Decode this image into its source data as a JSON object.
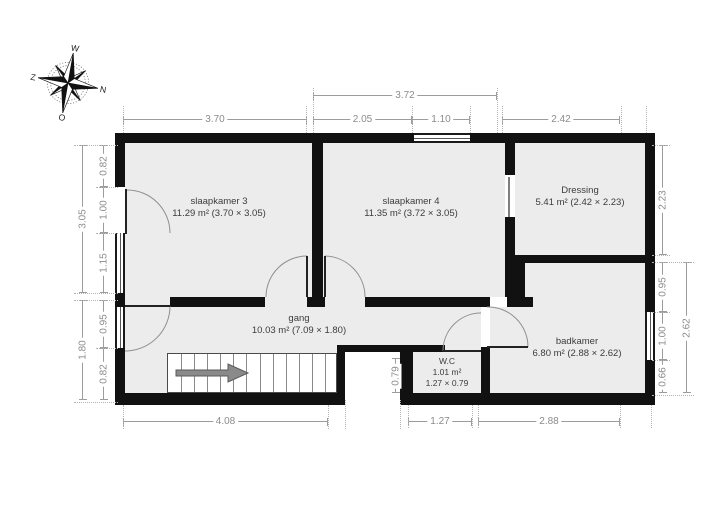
{
  "compass": {
    "top": "W",
    "right": "N",
    "bottom": "O",
    "left": "Z"
  },
  "rooms": [
    {
      "name": "slaapkamer 3",
      "info": "11.29 m² (3.70 × 3.05)"
    },
    {
      "name": "slaapkamer 4",
      "info": "11.35 m² (3.72 × 3.05)"
    },
    {
      "name": "Dressing",
      "info": "5.41 m² (2.42 × 2.23)"
    },
    {
      "name": "gang",
      "info": "10.03 m² (7.09 × 1.80)"
    },
    {
      "name": "W.C",
      "info": "1.01 m²",
      "info2": "1.27 × 0.79"
    },
    {
      "name": "badkamer",
      "info": "6.80 m² (2.88 × 2.62)"
    }
  ],
  "dimensions": [
    {
      "label": "3.72",
      "side": "top",
      "o": "h",
      "x": 313,
      "y": 95,
      "len": 184
    },
    {
      "label": "3.70",
      "side": "top",
      "o": "h",
      "x": 123,
      "y": 119,
      "len": 184
    },
    {
      "label": "2.05",
      "side": "top",
      "o": "h",
      "x": 313,
      "y": 119,
      "len": 99
    },
    {
      "label": "1.10",
      "side": "top",
      "o": "h",
      "x": 412,
      "y": 119,
      "len": 58
    },
    {
      "label": "2.42",
      "side": "top",
      "o": "h",
      "x": 502,
      "y": 119,
      "len": 118
    },
    {
      "label": "3.05",
      "side": "left",
      "o": "v",
      "x": 82,
      "y": 145,
      "len": 148
    },
    {
      "label": "1.80",
      "side": "left",
      "o": "v",
      "x": 82,
      "y": 300,
      "len": 100
    },
    {
      "label": "0.82",
      "side": "left",
      "o": "v",
      "x": 103,
      "y": 145,
      "len": 42
    },
    {
      "label": "1.00",
      "side": "left",
      "o": "v",
      "x": 103,
      "y": 187,
      "len": 46
    },
    {
      "label": "1.15",
      "side": "left",
      "o": "v",
      "x": 103,
      "y": 233,
      "len": 60
    },
    {
      "label": "0.95",
      "side": "left",
      "o": "v",
      "x": 103,
      "y": 300,
      "len": 48
    },
    {
      "label": "0.82",
      "side": "left",
      "o": "v",
      "x": 103,
      "y": 348,
      "len": 52
    },
    {
      "label": "2.23",
      "side": "right",
      "o": "v",
      "x": 662,
      "y": 145,
      "len": 110
    },
    {
      "label": "0.95",
      "side": "right",
      "o": "v",
      "x": 662,
      "y": 262,
      "len": 50
    },
    {
      "label": "1.00",
      "side": "right",
      "o": "v",
      "x": 662,
      "y": 312,
      "len": 48
    },
    {
      "label": "0.66",
      "side": "right",
      "o": "v",
      "x": 662,
      "y": 360,
      "len": 33
    },
    {
      "label": "2.62",
      "side": "right",
      "o": "v",
      "x": 686,
      "y": 262,
      "len": 131
    },
    {
      "label": "4.08",
      "side": "bottom",
      "o": "h",
      "x": 123,
      "y": 421,
      "len": 205
    },
    {
      "label": "1.27",
      "side": "bottom",
      "o": "h",
      "x": 408,
      "y": 421,
      "len": 64
    },
    {
      "label": "2.88",
      "side": "bottom",
      "o": "h",
      "x": 478,
      "y": 421,
      "len": 142
    },
    {
      "label": "0.79",
      "side": "inner",
      "o": "v",
      "x": 395,
      "y": 358,
      "len": 35
    }
  ]
}
